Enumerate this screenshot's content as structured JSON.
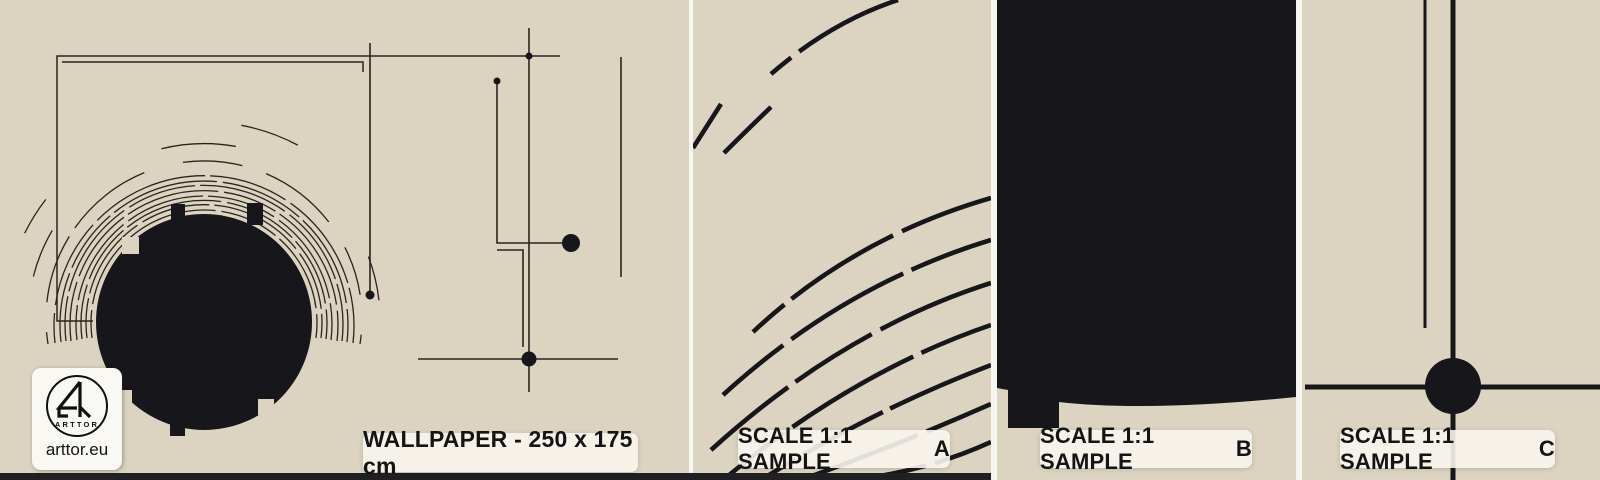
{
  "brand": {
    "logo_circle_text": "ARTTOR",
    "website": "arttor.eu"
  },
  "main_panel": {
    "label": "WALLPAPER - 250 x 175 cm"
  },
  "samples": [
    {
      "label_prefix": "SCALE 1:1 SAMPLE",
      "letter": "A"
    },
    {
      "label_prefix": "SCALE 1:1 SAMPLE",
      "letter": "B"
    },
    {
      "label_prefix": "SCALE 1:1 SAMPLE",
      "letter": "C"
    }
  ],
  "colors": {
    "beige": "#dcd3c1",
    "ink": "#17171b",
    "line": "#2a241c",
    "sep": "#f7f5ef",
    "strip": "#202023",
    "card": "#faf8f2",
    "labelbg": "#f8f5ee",
    "text": "#141414"
  }
}
